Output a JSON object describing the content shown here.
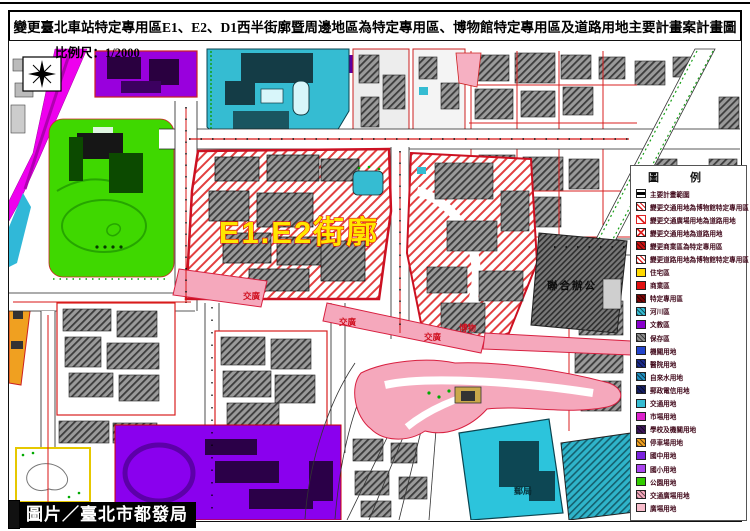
{
  "header": {
    "title": "變更臺北車站特定專用區E1、E2、D1西半街廓暨周邊地區為特定專用區、博物館特定專用區及道路用地主要計畫案計畫圖",
    "scale_label": "比例尺：1/2000"
  },
  "footer": {
    "credit": "圖片／臺北市都發局"
  },
  "map": {
    "block_label": "E1.E2街廓",
    "labels": {
      "transport_plaza": "交廣",
      "museum": "博物",
      "joint_office": "聯合辦公",
      "post_office": "郵局"
    }
  },
  "legend": {
    "title": "圖 例",
    "items": [
      {
        "label": "主要計畫範圍",
        "color": "#ffffff",
        "pattern": "line-h"
      },
      {
        "label": "變更交通用地為博物館特定專用區",
        "color": "#ffffff",
        "pattern": "hatch-red"
      },
      {
        "label": "變更交通廣場用地為道路用地",
        "color": "#ffffff",
        "pattern": "slash-red"
      },
      {
        "label": "變更交通用地為道路用地",
        "color": "#ffffff",
        "pattern": "cross-red"
      },
      {
        "label": "變更商業區為特定專用區",
        "color": "#cc1111",
        "pattern": "dark-hatch"
      },
      {
        "label": "變更道路用地為博物館特定專用區",
        "color": "#ffffff",
        "pattern": "hatch-red"
      },
      {
        "label": "住宅區",
        "color": "#ffd900",
        "pattern": "plain"
      },
      {
        "label": "商業區",
        "color": "#e01010",
        "pattern": "plain"
      },
      {
        "label": "特定專用區",
        "color": "#7a0505",
        "pattern": "dark-hatch"
      },
      {
        "label": "河川區",
        "color": "#35bcd2",
        "pattern": "dark-hatch"
      },
      {
        "label": "文教區",
        "color": "#8800cc",
        "pattern": "plain"
      },
      {
        "label": "保存區",
        "color": "#8a8a8a",
        "pattern": "dark-hatch"
      },
      {
        "label": "機關用地",
        "color": "#2244cc",
        "pattern": "plain"
      },
      {
        "label": "醫院用地",
        "color": "#1a2a8a",
        "pattern": "dark-hatch"
      },
      {
        "label": "自來水用地",
        "color": "#1f8fbf",
        "pattern": "dark-hatch"
      },
      {
        "label": "郵政電信用地",
        "color": "#141e64",
        "pattern": "dark-hatch"
      },
      {
        "label": "交通用地",
        "color": "#35bcd2",
        "pattern": "plain"
      },
      {
        "label": "市場用地",
        "color": "#dd22cc",
        "pattern": "plain"
      },
      {
        "label": "學校及機關用地",
        "color": "#3a1458",
        "pattern": "dark-hatch"
      },
      {
        "label": "停車場用地",
        "color": "#f0a020",
        "pattern": "dark-hatch"
      },
      {
        "label": "國中用地",
        "color": "#7a22dd",
        "pattern": "plain"
      },
      {
        "label": "國小用地",
        "color": "#aa44ee",
        "pattern": "plain"
      },
      {
        "label": "公園用地",
        "color": "#33cc00",
        "pattern": "plain"
      },
      {
        "label": "交通廣場用地",
        "color": "#f5a8bc",
        "pattern": "dark-hatch"
      },
      {
        "label": "廣場用地",
        "color": "#f8bccb",
        "pattern": "plain"
      }
    ]
  },
  "colors": {
    "plan_boundary_red": "#cc1122",
    "hatch_red": "#e24040",
    "station_cyan": "#35bcd2",
    "park_green": "#3fd800",
    "school_purple": "#8a00ee",
    "rail_magenta": "#ee00ee",
    "plaza_pink": "#f5a8bc",
    "orange_strip": "#f0a020",
    "block_label_fill": "#ffe600",
    "block_label_stroke": "#e01010"
  }
}
